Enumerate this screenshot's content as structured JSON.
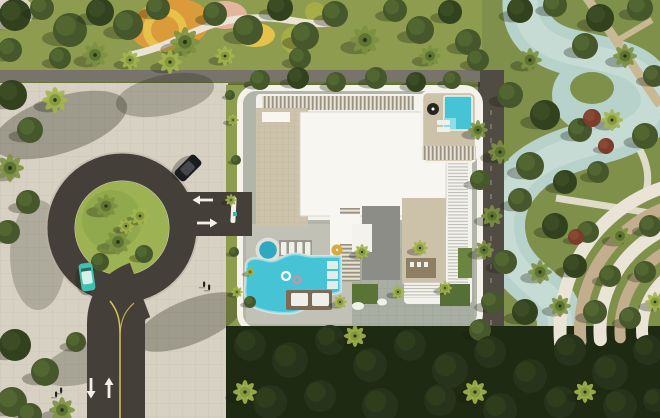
{
  "meta": {
    "title": "Aerial top-down 3D render of a residential development: white flat-roof building with rooftop pool, amenity pool deck, roundabout drop-off, lazy-river park and palm landscaping",
    "view": "top-down",
    "scene": "architectural-visualization"
  },
  "colors": {
    "lawn": "#8d9c4e",
    "park_grass": "#7e9049",
    "plaza": "#d7d1c3",
    "paving_line": "#b9b2a2",
    "wall": "#78746b",
    "asphalt": "#453f39",
    "island_grass": "#9db253",
    "island_grass_dark": "#86a047",
    "lane_yellow": "#d9c456",
    "arrow": "#f2f1e8",
    "site_ground": "#b2b6a9",
    "border_white": "#f4f2ea",
    "roof_white": "#f3f2ec",
    "roof_bright": "#f7f6f1",
    "roof_edge": "#d8d5ca",
    "louver_beige": "#cdc3ab",
    "louver_dark": "#6f6a5e",
    "tile_line": "#b9ae94",
    "gray_slab": "#8d8d88",
    "beige_slab": "#ccc1a9",
    "deck_gray": "#a9aea3",
    "deck_line": "#8f9488",
    "pool_deck": "#c1c1b6",
    "pool": "#46c4d6",
    "pool_light": "#8fdde8",
    "pool_curb": "#dfe0d6",
    "spa": "#2fa9bf",
    "river": "#b7d2cb",
    "river_light": "#d2e2da",
    "service_road": "#514c43",
    "path_beige": "#c9b894",
    "path_white": "#e9e4d6",
    "terrace_beige": "#c2ae8c",
    "dark_band": "#1f2a13",
    "wood_deck": "#7c6c57",
    "pergola_wood": "#8a7a60",
    "green_roof_a": "#5a7438",
    "green_roof_b": "#566f36",
    "green_roof_c": "#6b8440",
    "umbrella_yellow": "#d9a93c",
    "umbrella_dark": "#26261f",
    "playground_orange": "#dc9b3a",
    "playground_yellow": "#e6c24a",
    "playground_pink": "#e5b49f",
    "playground_green": "#a5ad46",
    "pale_corner": "#ddd6c6",
    "shadow": "rgba(25,30,15,0.30)",
    "car_black_body": "#1b1c1e",
    "car_black_roof": "#45474c",
    "car_teal_body": "#3fc0b0",
    "car_teal_roof": "#d8f0ea",
    "gate_white": "#f0efe8",
    "booth_teal": "#3fb7a8",
    "float_pink": "#e08a9a",
    "lounger_white": "#eef0ea",
    "person_dark": "#22261d"
  },
  "arrows": [
    {
      "x": 91,
      "y": 388,
      "dir": "down",
      "name": "lane-arrow-down"
    },
    {
      "x": 109,
      "y": 388,
      "dir": "up",
      "name": "lane-arrow-up"
    },
    {
      "x": 203,
      "y": 200,
      "dir": "left",
      "name": "exit-arrow-left"
    },
    {
      "x": 207,
      "y": 223,
      "dir": "right",
      "name": "entry-arrow-right"
    }
  ],
  "vehicles": [
    {
      "name": "black-car",
      "x": 188,
      "y": 168,
      "rot": 45,
      "body": "car_black_body",
      "roof": "car_black_roof"
    },
    {
      "name": "teal-car",
      "x": 87,
      "y": 277,
      "rot": -8,
      "body": "car_teal_body",
      "roof": "car_teal_roof"
    }
  ],
  "pedestrians": [
    {
      "x": 204,
      "y": 284
    },
    {
      "x": 209,
      "y": 287
    },
    {
      "x": 61,
      "y": 390
    },
    {
      "x": 56,
      "y": 394
    }
  ],
  "terraces": {
    "cx": 710,
    "cy": 330,
    "a1": 175,
    "a2": 255,
    "rings": [
      [
        150,
        13,
        "path_white"
      ],
      [
        130,
        12,
        "terrace_beige"
      ],
      [
        110,
        13,
        "path_white"
      ],
      [
        90,
        11,
        "terrace_beige"
      ],
      [
        68,
        12,
        "path_white"
      ]
    ]
  },
  "tree_palette": {
    "c": [
      "#46582b",
      "#5d7337"
    ],
    "d": [
      "#32421f",
      "#46582b"
    ],
    "p": [
      "#5e7433",
      "#7c9141"
    ],
    "b": [
      "#85993f",
      "#a3b54e"
    ],
    "r": [
      "#7b3c2c",
      "#94543c"
    ],
    "k": [
      "#27331a",
      "#35451f"
    ]
  },
  "trees": [
    [
      15,
      15,
      16,
      "d"
    ],
    [
      42,
      8,
      12,
      "c"
    ],
    [
      70,
      30,
      17,
      "c"
    ],
    [
      100,
      12,
      14,
      "d"
    ],
    [
      128,
      25,
      15,
      "c"
    ],
    [
      158,
      8,
      12,
      "c"
    ],
    [
      185,
      42,
      15,
      "p"
    ],
    [
      215,
      14,
      12,
      "c"
    ],
    [
      248,
      30,
      15,
      "c"
    ],
    [
      280,
      8,
      13,
      "d"
    ],
    [
      305,
      36,
      14,
      "c"
    ],
    [
      335,
      14,
      13,
      "c"
    ],
    [
      365,
      40,
      15,
      "p"
    ],
    [
      395,
      10,
      12,
      "c"
    ],
    [
      420,
      30,
      14,
      "c"
    ],
    [
      450,
      12,
      12,
      "d"
    ],
    [
      468,
      42,
      13,
      "c"
    ],
    [
      170,
      62,
      12,
      "b"
    ],
    [
      225,
      56,
      10,
      "b"
    ],
    [
      300,
      58,
      11,
      "c"
    ],
    [
      430,
      56,
      11,
      "p"
    ],
    [
      95,
      55,
      13,
      "p"
    ],
    [
      60,
      58,
      11,
      "c"
    ],
    [
      10,
      50,
      12,
      "c"
    ],
    [
      130,
      60,
      10,
      "b"
    ],
    [
      260,
      80,
      10,
      "c"
    ],
    [
      298,
      78,
      11,
      "d"
    ],
    [
      336,
      82,
      10,
      "c"
    ],
    [
      376,
      78,
      11,
      "c"
    ],
    [
      416,
      82,
      10,
      "d"
    ],
    [
      452,
      80,
      9,
      "c"
    ],
    [
      12,
      95,
      15,
      "d"
    ],
    [
      30,
      130,
      13,
      "c"
    ],
    [
      10,
      168,
      14,
      "p"
    ],
    [
      28,
      202,
      12,
      "c"
    ],
    [
      8,
      232,
      12,
      "c"
    ],
    [
      55,
      100,
      13,
      "b"
    ],
    [
      15,
      345,
      16,
      "d"
    ],
    [
      45,
      372,
      14,
      "c"
    ],
    [
      12,
      402,
      15,
      "c"
    ],
    [
      62,
      410,
      13,
      "p"
    ],
    [
      76,
      342,
      10,
      "c"
    ],
    [
      30,
      415,
      12,
      "c"
    ],
    [
      106,
      206,
      12,
      "p"
    ],
    [
      140,
      216,
      10,
      "b"
    ],
    [
      118,
      242,
      13,
      "p"
    ],
    [
      144,
      254,
      9,
      "c"
    ],
    [
      100,
      262,
      9,
      "c"
    ],
    [
      126,
      226,
      8,
      "b"
    ],
    [
      233,
      120,
      6,
      "b"
    ],
    [
      236,
      160,
      5,
      "c"
    ],
    [
      231,
      200,
      6,
      "b"
    ],
    [
      234,
      252,
      5,
      "c"
    ],
    [
      237,
      292,
      6,
      "b"
    ],
    [
      230,
      95,
      5,
      "c"
    ],
    [
      520,
      10,
      13,
      "d"
    ],
    [
      555,
      5,
      12,
      "c"
    ],
    [
      600,
      18,
      14,
      "d"
    ],
    [
      640,
      8,
      13,
      "c"
    ],
    [
      585,
      46,
      13,
      "c"
    ],
    [
      530,
      60,
      12,
      "p"
    ],
    [
      625,
      56,
      12,
      "p"
    ],
    [
      654,
      76,
      11,
      "c"
    ],
    [
      510,
      95,
      13,
      "c"
    ],
    [
      545,
      115,
      15,
      "d"
    ],
    [
      580,
      130,
      12,
      "c"
    ],
    [
      612,
      120,
      11,
      "b"
    ],
    [
      645,
      136,
      13,
      "c"
    ],
    [
      500,
      152,
      12,
      "p"
    ],
    [
      530,
      166,
      14,
      "c"
    ],
    [
      565,
      182,
      12,
      "d"
    ],
    [
      598,
      172,
      11,
      "c"
    ],
    [
      520,
      200,
      12,
      "c"
    ],
    [
      492,
      216,
      11,
      "p"
    ],
    [
      555,
      226,
      13,
      "d"
    ],
    [
      588,
      232,
      11,
      "c"
    ],
    [
      620,
      236,
      11,
      "p"
    ],
    [
      650,
      226,
      11,
      "c"
    ],
    [
      505,
      262,
      12,
      "c"
    ],
    [
      540,
      272,
      12,
      "p"
    ],
    [
      575,
      266,
      12,
      "d"
    ],
    [
      610,
      276,
      11,
      "c"
    ],
    [
      645,
      272,
      11,
      "c"
    ],
    [
      492,
      302,
      11,
      "c"
    ],
    [
      525,
      312,
      13,
      "d"
    ],
    [
      560,
      306,
      11,
      "p"
    ],
    [
      595,
      312,
      12,
      "c"
    ],
    [
      630,
      318,
      11,
      "c"
    ],
    [
      655,
      302,
      10,
      "b"
    ],
    [
      592,
      118,
      9,
      "r"
    ],
    [
      606,
      146,
      8,
      "r"
    ],
    [
      576,
      237,
      8,
      "r"
    ],
    [
      478,
      60,
      11,
      "c"
    ],
    [
      478,
      130,
      10,
      "p"
    ],
    [
      480,
      180,
      10,
      "c"
    ],
    [
      484,
      250,
      10,
      "p"
    ],
    [
      480,
      330,
      11,
      "c"
    ],
    [
      250,
      345,
      16,
      "k"
    ],
    [
      290,
      360,
      18,
      "k"
    ],
    [
      330,
      340,
      15,
      "k"
    ],
    [
      370,
      365,
      17,
      "k"
    ],
    [
      410,
      345,
      16,
      "k"
    ],
    [
      450,
      370,
      18,
      "k"
    ],
    [
      490,
      352,
      16,
      "k"
    ],
    [
      530,
      376,
      17,
      "k"
    ],
    [
      570,
      350,
      16,
      "k"
    ],
    [
      610,
      372,
      18,
      "k"
    ],
    [
      648,
      350,
      15,
      "k"
    ],
    [
      270,
      402,
      17,
      "k"
    ],
    [
      320,
      396,
      16,
      "k"
    ],
    [
      380,
      406,
      18,
      "k"
    ],
    [
      440,
      400,
      16,
      "k"
    ],
    [
      500,
      410,
      17,
      "k"
    ],
    [
      560,
      402,
      16,
      "k"
    ],
    [
      620,
      406,
      17,
      "k"
    ],
    [
      655,
      400,
      12,
      "k"
    ],
    [
      355,
      336,
      11,
      "b"
    ],
    [
      475,
      392,
      12,
      "b"
    ],
    [
      585,
      392,
      11,
      "b"
    ],
    [
      245,
      392,
      12,
      "b"
    ],
    [
      362,
      252,
      8,
      "b"
    ],
    [
      420,
      248,
      8,
      "b"
    ],
    [
      398,
      292,
      7,
      "b"
    ],
    [
      445,
      288,
      7,
      "b"
    ],
    [
      340,
      302,
      7,
      "b"
    ],
    [
      250,
      272,
      5,
      "b"
    ],
    [
      250,
      302,
      6,
      "c"
    ]
  ]
}
